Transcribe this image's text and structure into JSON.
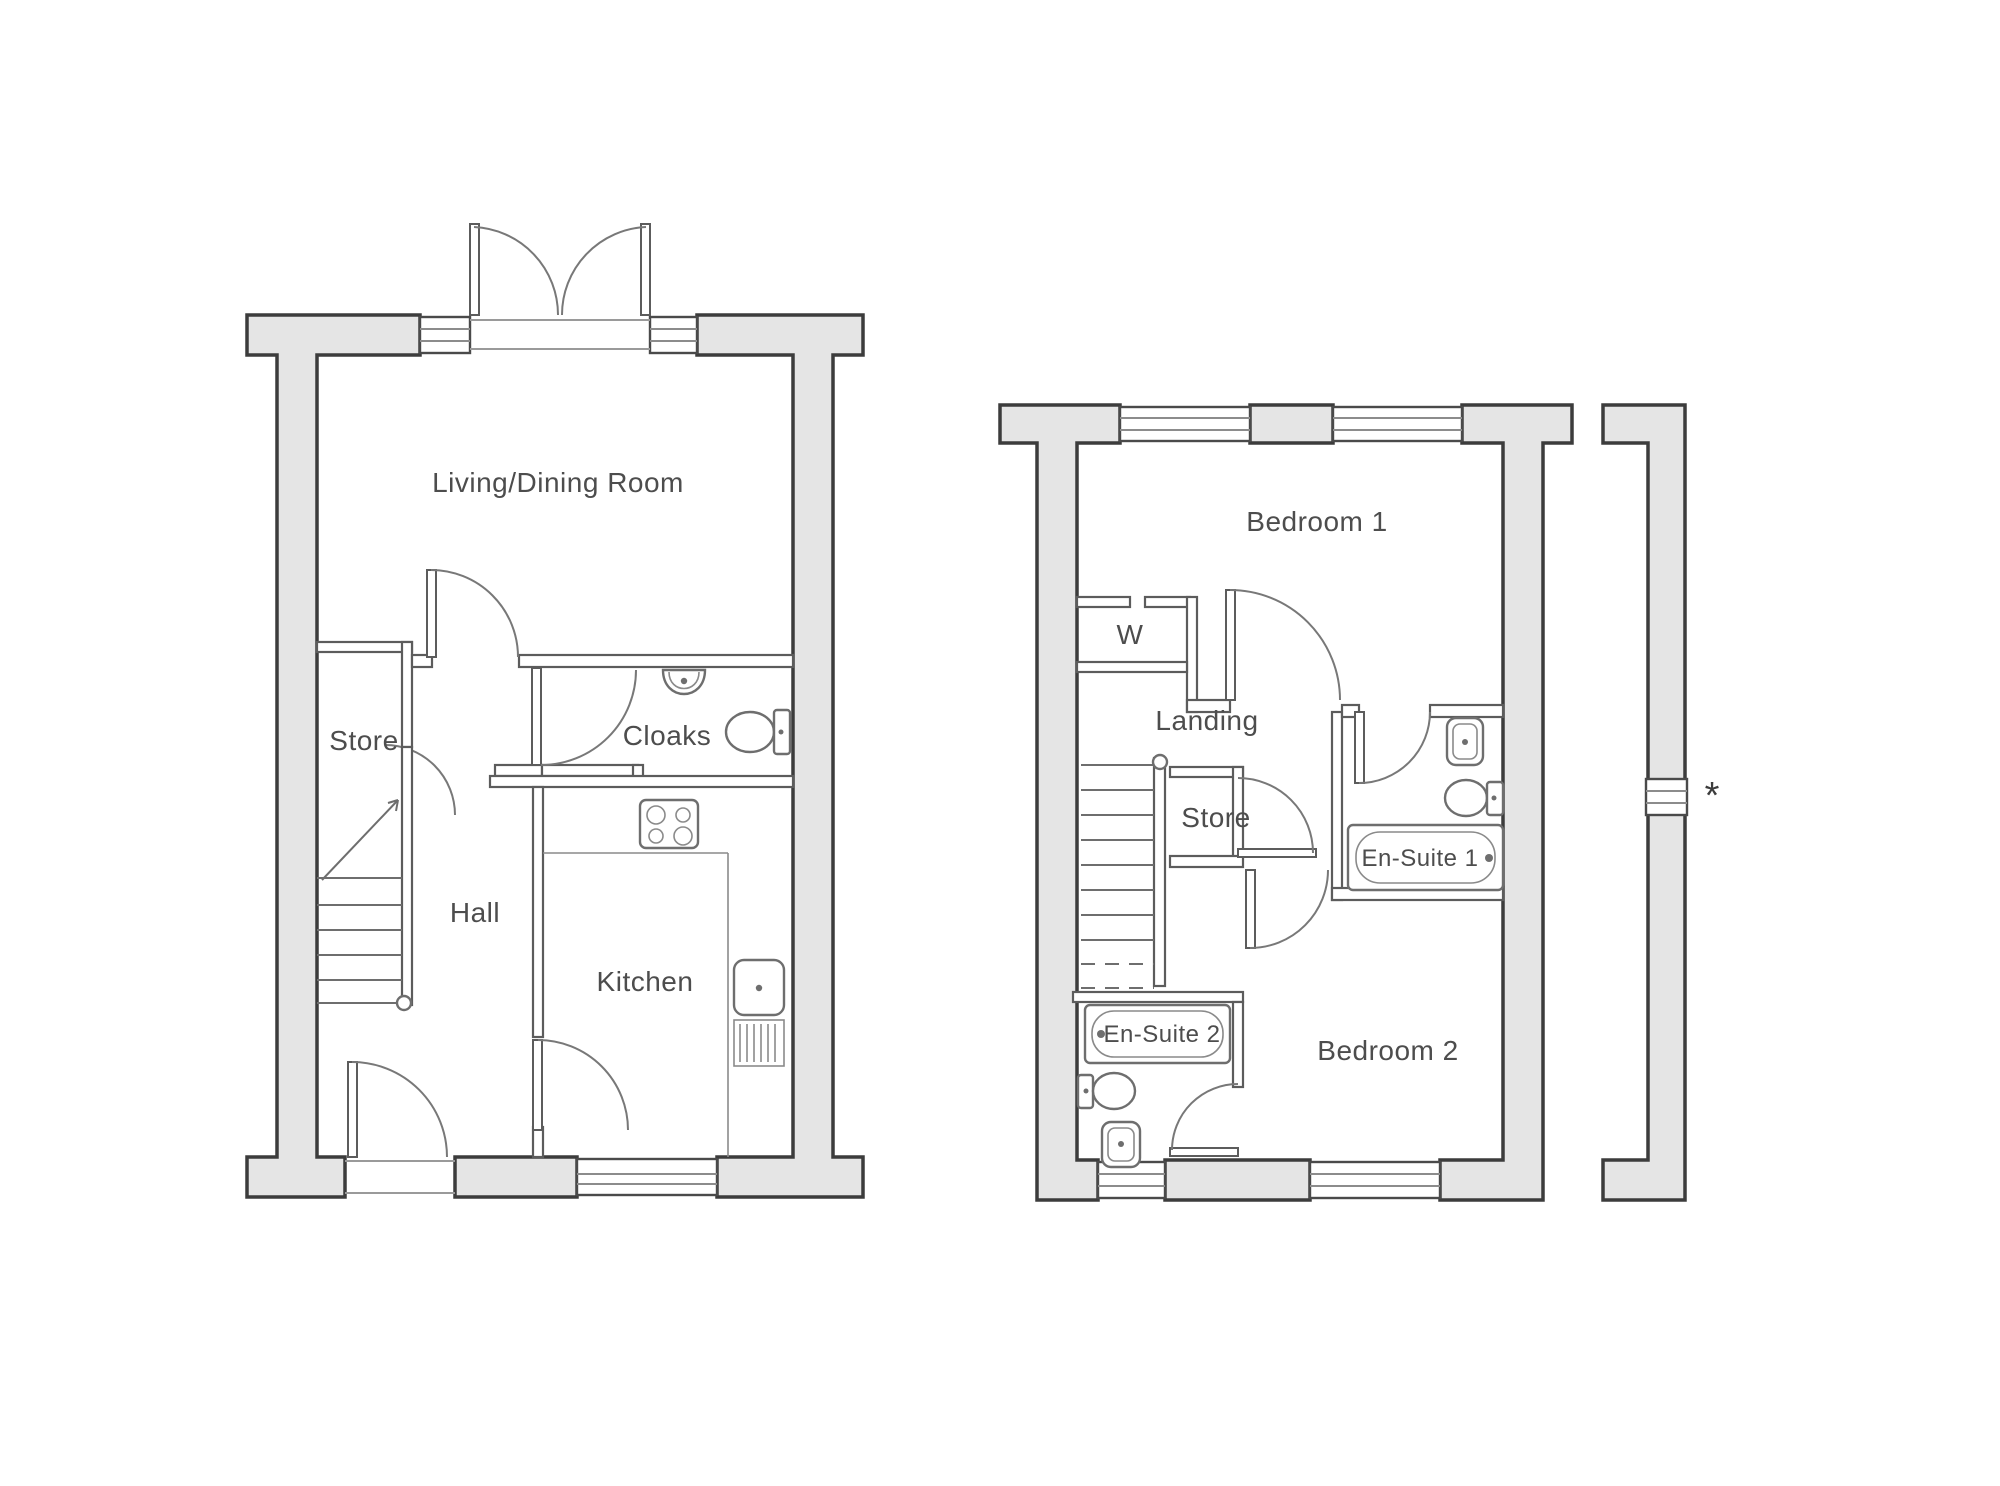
{
  "document": {
    "type": "property-floorplan",
    "background": "#ffffff",
    "colors": {
      "wall_fill": "#e5e5e5",
      "wall_outline": "#3c3c3c",
      "interior_wall_line": "#5c5c5c",
      "label_text": "#4d4d4d"
    }
  },
  "ground_floor": {
    "rooms": {
      "living_dining_room": "Living/Dining Room",
      "store": "Store",
      "cloaks": "Cloaks",
      "hall": "Hall",
      "kitchen": "Kitchen"
    }
  },
  "first_floor": {
    "rooms": {
      "bedroom_1": "Bedroom 1",
      "wardrobe": "W",
      "landing": "Landing",
      "store": "Store",
      "en_suite_1": "En-Suite 1",
      "en_suite_2": "En-Suite 2",
      "bedroom_2": "Bedroom 2"
    },
    "annotation_marker": "*"
  }
}
